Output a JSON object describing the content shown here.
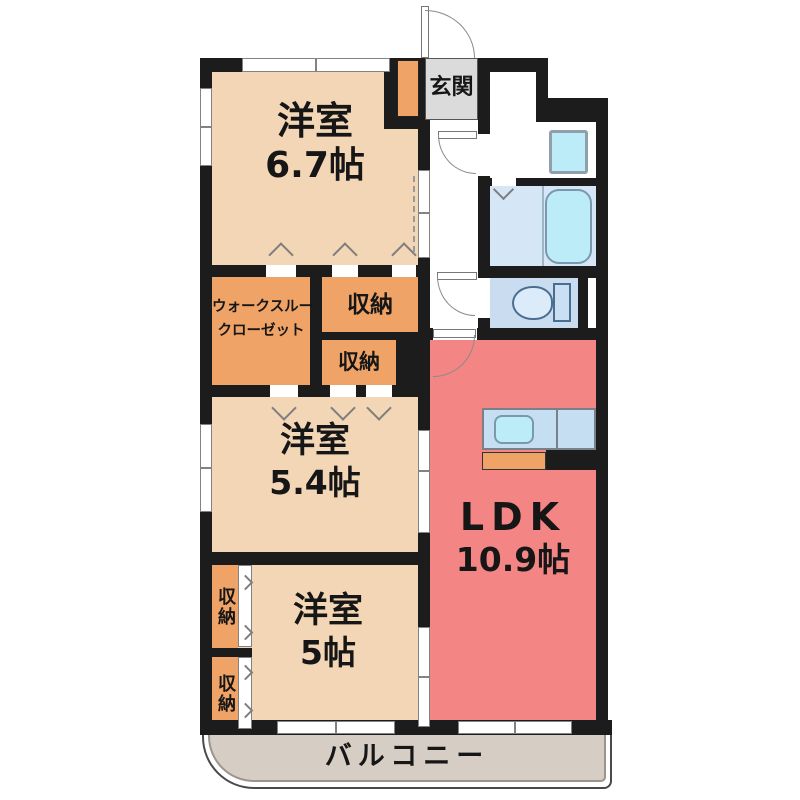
{
  "rooms": {
    "bedroom1": {
      "name": "洋室",
      "size": "6.7帖"
    },
    "bedroom2": {
      "name": "洋室",
      "size": "5.4帖"
    },
    "bedroom3": {
      "name": "洋室",
      "size": "5帖"
    },
    "ldk": {
      "name": "LDK",
      "size": "10.9帖"
    },
    "walk_through_closet": {
      "line1": "ウォークスルー",
      "line2": "クローゼット"
    },
    "entrance": {
      "label": "玄関"
    },
    "balcony": {
      "label": "バルコニー"
    }
  },
  "storage_units": [
    {
      "label": "収納"
    },
    {
      "label": "収納"
    },
    {
      "label": "収納"
    },
    {
      "label": "収納"
    }
  ],
  "icons": {
    "bathtub": "bathtub-icon",
    "toilet": "toilet-icon",
    "kitchen_sink": "kitchen-sink-icon",
    "washing_machine_pan": "washing-machine-pan-icon"
  },
  "colors": {
    "wall": "#1c1c1c",
    "bedroom_fill": "#f3d6b6",
    "storage_fill": "#efa366",
    "ldk_fill": "#f48585",
    "entrance_fill": "#dbdbdb",
    "balcony_fill": "#d6cec5",
    "bath_floor": "#d5e7f7",
    "toilet_floor": "#c9dcf0",
    "kitchen_counter": "#c6def2",
    "fixture_cyan": "#bcecf8"
  }
}
